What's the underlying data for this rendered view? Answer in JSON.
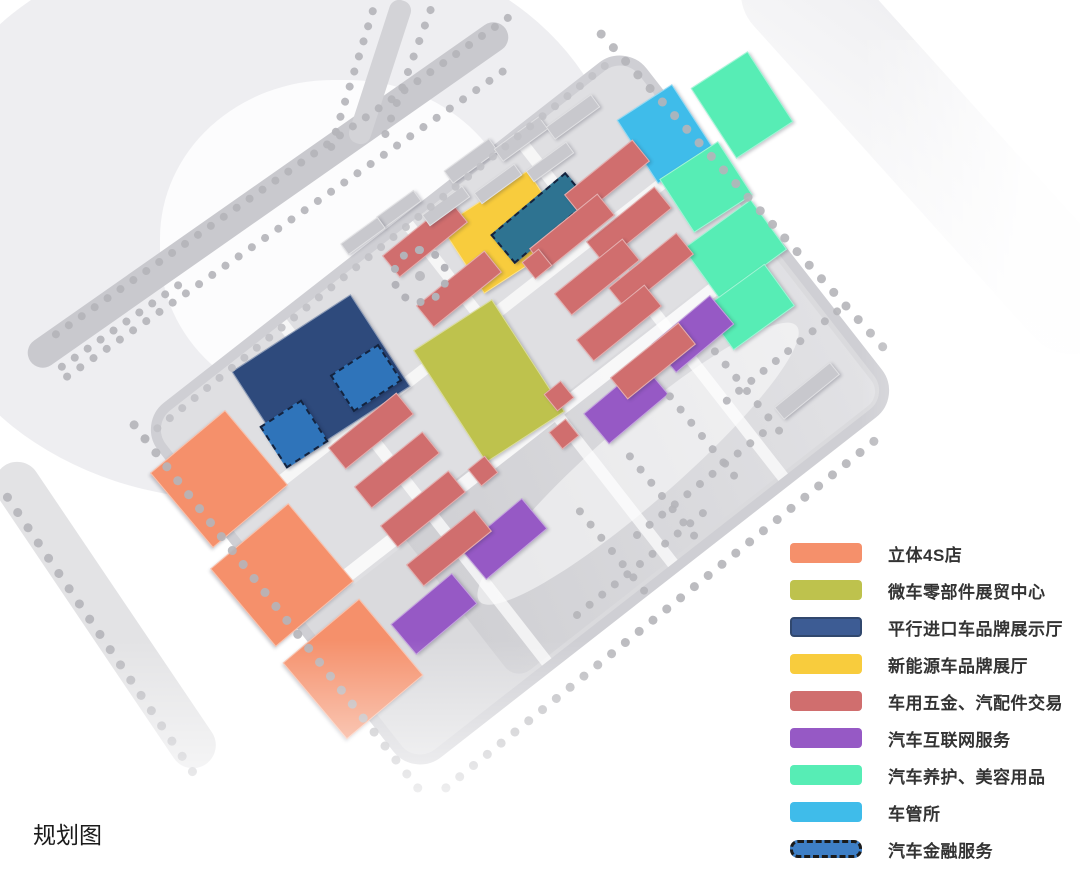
{
  "caption": "规划图",
  "legend": {
    "items": [
      {
        "id": "solid-4s",
        "label": "立体4S店",
        "color": "#F5906B",
        "style": "solid"
      },
      {
        "id": "micro-parts",
        "label": "微车零部件展贸中心",
        "color": "#BEC24D",
        "style": "solid"
      },
      {
        "id": "parallel-import",
        "label": "平行进口车品牌展示厅",
        "color": "#3D5C94",
        "style": "solid",
        "swatch_border": "#31486E"
      },
      {
        "id": "new-energy",
        "label": "新能源车品牌展厅",
        "color": "#F8CC3D",
        "style": "solid"
      },
      {
        "id": "hardware-parts",
        "label": "车用五金、汽配件交易",
        "color": "#D06E6E",
        "style": "solid"
      },
      {
        "id": "internet-service",
        "label": "汽车互联网服务",
        "color": "#9659C5",
        "style": "solid"
      },
      {
        "id": "care-beauty",
        "label": "汽车养护、美容用品",
        "color": "#57EDB5",
        "style": "solid"
      },
      {
        "id": "vehicle-admin",
        "label": "车管所",
        "color": "#3FBCEA",
        "style": "solid"
      },
      {
        "id": "auto-finance",
        "label": "汽车金融服务",
        "color": "#3E7FC6",
        "style": "dashed"
      }
    ]
  },
  "map": {
    "other_colors": {
      "gray": "#c8c8cd"
    },
    "buildings": [
      {
        "n": "solid-4s-store-1",
        "t": "solid-4s",
        "x": 218,
        "y": 478,
        "w": 96,
        "h": 96,
        "r": 50
      },
      {
        "n": "solid-4s-store-2",
        "t": "solid-4s",
        "x": 281,
        "y": 574,
        "w": 100,
        "h": 100,
        "r": 50
      },
      {
        "n": "solid-4s-store-3",
        "t": "solid-4s",
        "x": 352,
        "y": 668,
        "w": 98,
        "h": 98,
        "r": 50
      },
      {
        "n": "parallel-import-hall",
        "t": "parallel-import",
        "x": 320,
        "y": 378,
        "w": 140,
        "h": 108,
        "r": -33,
        "fill": "#2E4A7C"
      },
      {
        "n": "auto-finance-site-1",
        "t": "auto-finance",
        "x": 292,
        "y": 432,
        "w": 46,
        "h": 46,
        "r": -33,
        "dashed": true,
        "fill": "#2F74BA"
      },
      {
        "n": "auto-finance-site-2",
        "t": "auto-finance",
        "x": 364,
        "y": 376,
        "w": 54,
        "h": 40,
        "r": -33,
        "dashed": true,
        "fill": "#2F74BA"
      },
      {
        "n": "new-energy-hall",
        "t": "new-energy",
        "x": 505,
        "y": 231,
        "w": 102,
        "h": 78,
        "r": -33
      },
      {
        "n": "auto-finance-site-3",
        "t": "auto-finance",
        "x": 538,
        "y": 216,
        "w": 94,
        "h": 34,
        "r": -40,
        "dashed": true,
        "fill": "#2E7391"
      },
      {
        "n": "micro-parts-center",
        "t": "micro-parts",
        "x": 488,
        "y": 380,
        "w": 92,
        "h": 132,
        "r": -33
      },
      {
        "n": "vehicle-admin-office",
        "t": "vehicle-admin",
        "x": 664,
        "y": 133,
        "w": 64,
        "h": 74,
        "r": -33
      },
      {
        "n": "care-beauty-1",
        "t": "care-beauty",
        "x": 741,
        "y": 104,
        "w": 66,
        "h": 82,
        "r": -33
      },
      {
        "n": "care-beauty-2",
        "t": "care-beauty",
        "x": 705,
        "y": 186,
        "w": 68,
        "h": 62,
        "r": -33
      },
      {
        "n": "care-beauty-3",
        "t": "care-beauty",
        "x": 734,
        "y": 248,
        "w": 82,
        "h": 60,
        "r": -36
      },
      {
        "n": "care-beauty-4",
        "t": "care-beauty",
        "x": 748,
        "y": 306,
        "w": 74,
        "h": 50,
        "r": -36
      },
      {
        "n": "internet-service-1",
        "t": "internet-service",
        "x": 692,
        "y": 333,
        "w": 74,
        "h": 36,
        "r": -40
      },
      {
        "n": "internet-service-2",
        "t": "internet-service",
        "x": 625,
        "y": 403,
        "w": 76,
        "h": 38,
        "r": -40
      },
      {
        "n": "internet-service-3",
        "t": "internet-service",
        "x": 503,
        "y": 538,
        "w": 78,
        "h": 38,
        "r": -40
      },
      {
        "n": "internet-service-4",
        "t": "internet-service",
        "x": 433,
        "y": 613,
        "w": 78,
        "h": 38,
        "r": -40
      },
      {
        "n": "hardware-bar-1",
        "t": "hardware-parts",
        "x": 606,
        "y": 177,
        "w": 86,
        "h": 26,
        "r": -39
      },
      {
        "n": "hardware-bar-2",
        "t": "hardware-parts",
        "x": 628,
        "y": 224,
        "w": 86,
        "h": 26,
        "r": -39
      },
      {
        "n": "hardware-bar-3",
        "t": "hardware-parts",
        "x": 571,
        "y": 231,
        "w": 86,
        "h": 26,
        "r": -39
      },
      {
        "n": "hardware-bar-4",
        "t": "hardware-parts",
        "x": 596,
        "y": 276,
        "w": 86,
        "h": 26,
        "r": -39
      },
      {
        "n": "hardware-bar-5",
        "t": "hardware-parts",
        "x": 650,
        "y": 270,
        "w": 86,
        "h": 26,
        "r": -39
      },
      {
        "n": "hardware-bar-6",
        "t": "hardware-parts",
        "x": 618,
        "y": 322,
        "w": 86,
        "h": 26,
        "r": -39
      },
      {
        "n": "hardware-bar-7",
        "t": "hardware-parts",
        "x": 652,
        "y": 360,
        "w": 86,
        "h": 26,
        "r": -39
      },
      {
        "n": "hardware-bar-8",
        "t": "hardware-parts",
        "x": 370,
        "y": 430,
        "w": 86,
        "h": 26,
        "r": -39
      },
      {
        "n": "hardware-bar-9",
        "t": "hardware-parts",
        "x": 396,
        "y": 469,
        "w": 86,
        "h": 26,
        "r": -39
      },
      {
        "n": "hardware-bar-10",
        "t": "hardware-parts",
        "x": 422,
        "y": 508,
        "w": 86,
        "h": 26,
        "r": -39
      },
      {
        "n": "hardware-bar-11",
        "t": "hardware-parts",
        "x": 448,
        "y": 547,
        "w": 86,
        "h": 26,
        "r": -39
      },
      {
        "n": "hardware-bar-12",
        "t": "hardware-parts",
        "x": 424,
        "y": 238,
        "w": 86,
        "h": 26,
        "r": -39
      },
      {
        "n": "hardware-bar-13",
        "t": "hardware-parts",
        "x": 458,
        "y": 288,
        "w": 86,
        "h": 26,
        "r": -39
      },
      {
        "n": "hardware-sq-1",
        "t": "hardware-parts",
        "x": 536,
        "y": 263,
        "w": 20,
        "h": 20,
        "r": -39
      },
      {
        "n": "hardware-sq-2",
        "t": "hardware-parts",
        "x": 558,
        "y": 395,
        "w": 20,
        "h": 20,
        "r": -39
      },
      {
        "n": "hardware-sq-3",
        "t": "hardware-parts",
        "x": 563,
        "y": 433,
        "w": 20,
        "h": 20,
        "r": -39
      },
      {
        "n": "hardware-sq-4",
        "t": "hardware-parts",
        "x": 482,
        "y": 470,
        "w": 20,
        "h": 20,
        "r": -39
      },
      {
        "n": "service-building-1",
        "t": "gray",
        "x": 470,
        "y": 160,
        "w": 54,
        "h": 14,
        "r": -36
      },
      {
        "n": "service-building-2",
        "t": "gray",
        "x": 520,
        "y": 138,
        "w": 54,
        "h": 14,
        "r": -36
      },
      {
        "n": "service-building-3",
        "t": "gray",
        "x": 572,
        "y": 116,
        "w": 54,
        "h": 14,
        "r": -36
      },
      {
        "n": "service-building-4",
        "t": "gray",
        "x": 445,
        "y": 205,
        "w": 48,
        "h": 12,
        "r": -36
      },
      {
        "n": "service-building-5",
        "t": "gray",
        "x": 497,
        "y": 183,
        "w": 48,
        "h": 12,
        "r": -36
      },
      {
        "n": "service-building-6",
        "t": "gray",
        "x": 549,
        "y": 161,
        "w": 48,
        "h": 12,
        "r": -36
      },
      {
        "n": "service-building-7",
        "t": "gray",
        "x": 398,
        "y": 208,
        "w": 44,
        "h": 12,
        "r": -36
      },
      {
        "n": "service-building-8",
        "t": "gray",
        "x": 362,
        "y": 235,
        "w": 44,
        "h": 12,
        "r": -36
      },
      {
        "n": "service-building-9",
        "t": "gray",
        "x": 806,
        "y": 390,
        "w": 70,
        "h": 14,
        "r": -39
      }
    ]
  }
}
